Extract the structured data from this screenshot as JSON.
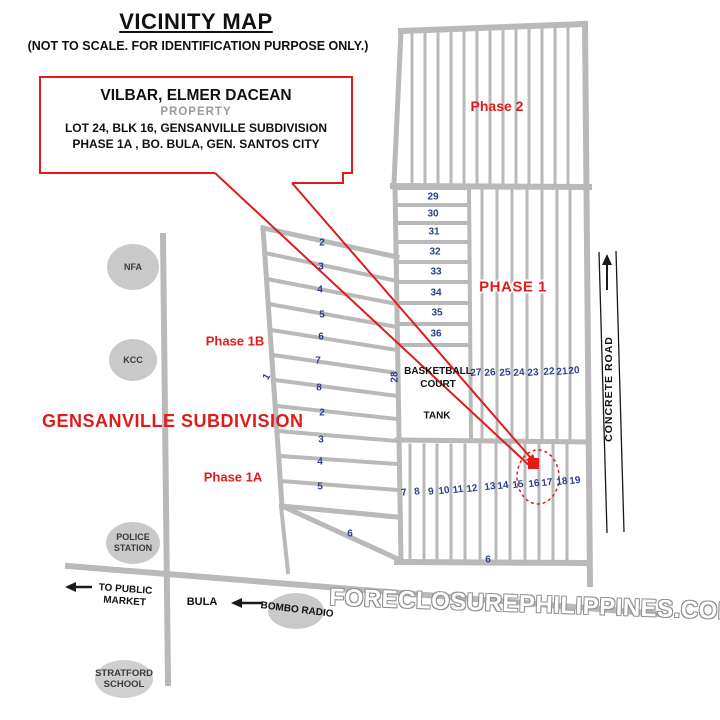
{
  "title": "VICINITY MAP",
  "subtitle": "(NOT TO SCALE. FOR IDENTIFICATION PURPOSE ONLY.)",
  "property_box": {
    "owner": "VILBAR, ELMER DACEAN",
    "property_label": "PROPERTY",
    "line1": "LOT 24, BLK 16, GENSANVILLE SUBDIVISION",
    "line2": "PHASE 1A , BO. BULA,  GEN. SANTOS CITY"
  },
  "labels": {
    "subdivision": "GENSANVILLE SUBDIVISION",
    "phase2": "Phase 2",
    "phase1": "PHASE 1",
    "phase1b": "Phase 1B",
    "phase1a": "Phase 1A",
    "basketball_line1": "BASKETBALL",
    "basketball_line2": "COURT",
    "tank": "TANK",
    "concrete_road": "CONCRETE ROAD",
    "bula": "BULA",
    "to_public_market_line1": "TO PUBLIC",
    "to_public_market_line2": "MARKET",
    "bombo_radio": "BOMBO RADIO",
    "nfa": "NFA",
    "kcc": "KCC",
    "police_line1": "POLICE",
    "police_line2": "STATION",
    "stratford_line1": "STRATFORD",
    "stratford_line2": "SCHOOL",
    "watermark": "FORECLOSUREPHILIPPINES.COM"
  },
  "colors": {
    "accent_red": "#e01b1b",
    "lot_number_blue": "#2b3f8c",
    "road_gray": "#b9b9b9",
    "landmark_gray": "#c9c9c9",
    "concrete_road_black": "#1a1a1a",
    "watermark_outline": "#909090"
  },
  "lot_labels": [
    {
      "t": "2",
      "x": 322,
      "y": 243
    },
    {
      "t": "3",
      "x": 321,
      "y": 267
    },
    {
      "t": "4",
      "x": 320,
      "y": 290
    },
    {
      "t": "5",
      "x": 322,
      "y": 315
    },
    {
      "t": "6",
      "x": 321,
      "y": 337
    },
    {
      "t": "7",
      "x": 318,
      "y": 361
    },
    {
      "t": "8",
      "x": 319,
      "y": 388
    },
    {
      "t": "2",
      "x": 322,
      "y": 413
    },
    {
      "t": "3",
      "x": 321,
      "y": 440
    },
    {
      "t": "4",
      "x": 320,
      "y": 462
    },
    {
      "t": "5",
      "x": 320,
      "y": 487
    },
    {
      "t": "6",
      "x": 350,
      "y": 534
    },
    {
      "t": "1",
      "x": 267,
      "y": 377,
      "r": -60
    },
    {
      "t": "28",
      "x": 395,
      "y": 377,
      "r": -90
    },
    {
      "t": "29",
      "x": 433,
      "y": 197
    },
    {
      "t": "30",
      "x": 433,
      "y": 214
    },
    {
      "t": "31",
      "x": 434,
      "y": 232
    },
    {
      "t": "32",
      "x": 435,
      "y": 252
    },
    {
      "t": "33",
      "x": 436,
      "y": 272
    },
    {
      "t": "34",
      "x": 436,
      "y": 293
    },
    {
      "t": "35",
      "x": 437,
      "y": 313
    },
    {
      "t": "36",
      "x": 436,
      "y": 334
    },
    {
      "t": "27",
      "x": 476,
      "y": 373,
      "r": -5
    },
    {
      "t": "26",
      "x": 490,
      "y": 373,
      "r": -5
    },
    {
      "t": "25",
      "x": 505,
      "y": 373,
      "r": -5
    },
    {
      "t": "24",
      "x": 519,
      "y": 373,
      "r": -5
    },
    {
      "t": "23",
      "x": 533,
      "y": 373,
      "r": -5
    },
    {
      "t": "22",
      "x": 549,
      "y": 372,
      "r": -5
    },
    {
      "t": "21",
      "x": 562,
      "y": 372,
      "r": -5
    },
    {
      "t": "20",
      "x": 574,
      "y": 371,
      "r": -5
    },
    {
      "t": "7",
      "x": 404,
      "y": 493,
      "r": -8
    },
    {
      "t": "8",
      "x": 417,
      "y": 492,
      "r": -8
    },
    {
      "t": "9",
      "x": 431,
      "y": 492,
      "r": -8
    },
    {
      "t": "10",
      "x": 444,
      "y": 491,
      "r": -8
    },
    {
      "t": "11",
      "x": 458,
      "y": 490,
      "r": -8
    },
    {
      "t": "12",
      "x": 472,
      "y": 489,
      "r": -8
    },
    {
      "t": "13",
      "x": 490,
      "y": 487,
      "r": -8
    },
    {
      "t": "14",
      "x": 503,
      "y": 486,
      "r": -8
    },
    {
      "t": "15",
      "x": 518,
      "y": 485,
      "r": -8
    },
    {
      "t": "16",
      "x": 534,
      "y": 484,
      "r": -8
    },
    {
      "t": "17",
      "x": 547,
      "y": 483,
      "r": -8
    },
    {
      "t": "18",
      "x": 562,
      "y": 482,
      "r": -8
    },
    {
      "t": "19",
      "x": 575,
      "y": 481,
      "r": -8
    },
    {
      "t": "6",
      "x": 488,
      "y": 560
    }
  ]
}
